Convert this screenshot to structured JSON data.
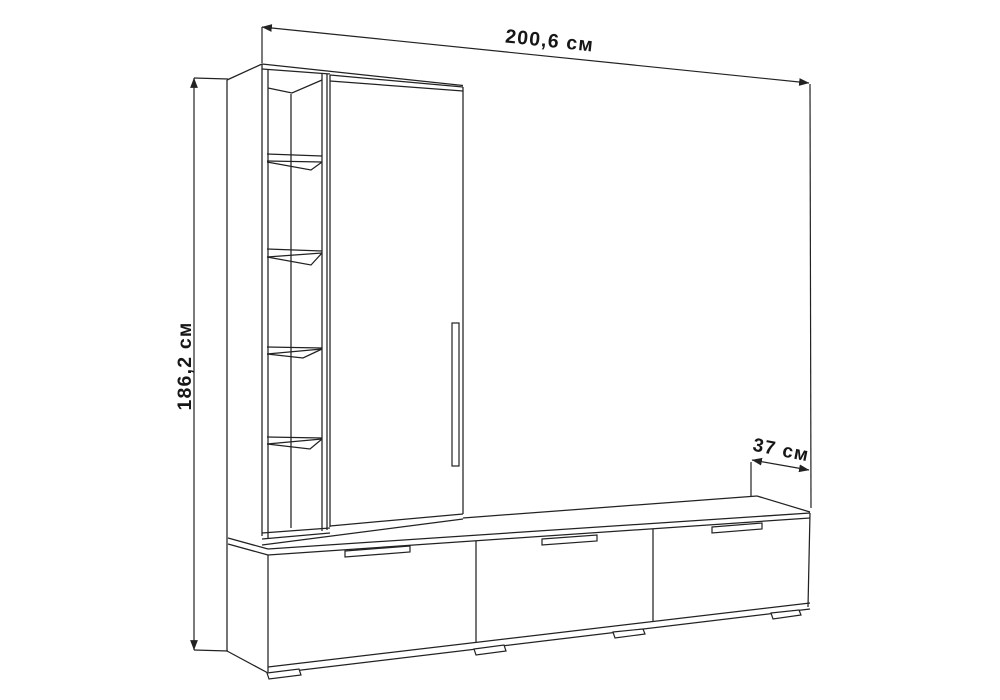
{
  "colors": {
    "background": "#ffffff",
    "line": "#222222",
    "text": "#161616"
  },
  "diagram": {
    "type": "furniture-dimension-drawing",
    "subject": "wall unit with open shelf column, wardrobe door and three-drawer TV bench",
    "dimensions": {
      "width": {
        "label": "200,6 см"
      },
      "height": {
        "label": "186,2 см"
      },
      "depth": {
        "label": "37 см"
      }
    },
    "furniture": {
      "shelf_compartments": 5,
      "shelves": 4,
      "doors": 1,
      "door_handles": 1,
      "drawers": 3,
      "drawer_handles": 3,
      "feet": 4
    }
  }
}
